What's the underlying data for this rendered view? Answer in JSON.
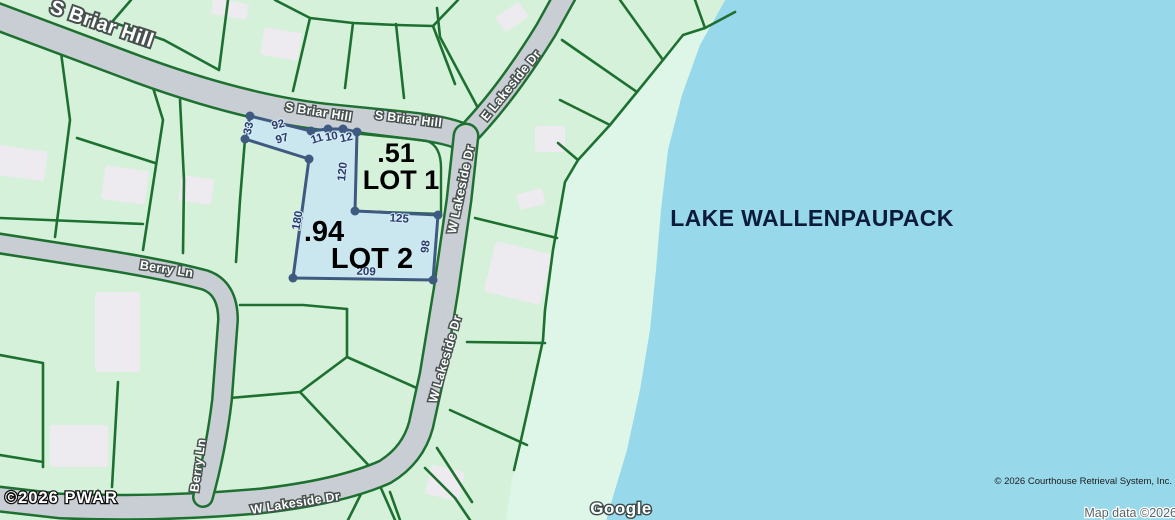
{
  "roads": {
    "s_briar_hill": "S Briar Hill",
    "e_lakeside_dr": "E Lakeside Dr",
    "w_lakeside_dr": "W Lakeside Dr",
    "berry_ln": "Berry Ln"
  },
  "lake": {
    "name": "LAKE WALLENPAUPACK"
  },
  "parcels": {
    "lot1": {
      "name": "LOT 1",
      "acreage": ".51"
    },
    "lot2": {
      "name": "LOT 2",
      "acreage": ".94"
    },
    "dimensions": {
      "d33": "33",
      "d92": "92",
      "d97": "97",
      "d11": "11",
      "d10": "10",
      "d12": "12",
      "d120": "120",
      "d125": "125",
      "d98": "98",
      "d180": "180",
      "d209": "209"
    }
  },
  "attribution": {
    "crs": "© 2026 Courthouse Retrieval System, Inc.",
    "map_data": "Map data ©2026",
    "pwar": "©2026 PWAR",
    "google": "Google"
  },
  "colors": {
    "land": "#d5f1da",
    "shore_strip": "#def6e7",
    "lake": "#97d8ea",
    "road": "#c9ced4",
    "lot_line": "#1d7030",
    "building": "#edeaf0",
    "parcel_fill": "#c9e6f2",
    "parcel_outline": "#3f5a80"
  }
}
